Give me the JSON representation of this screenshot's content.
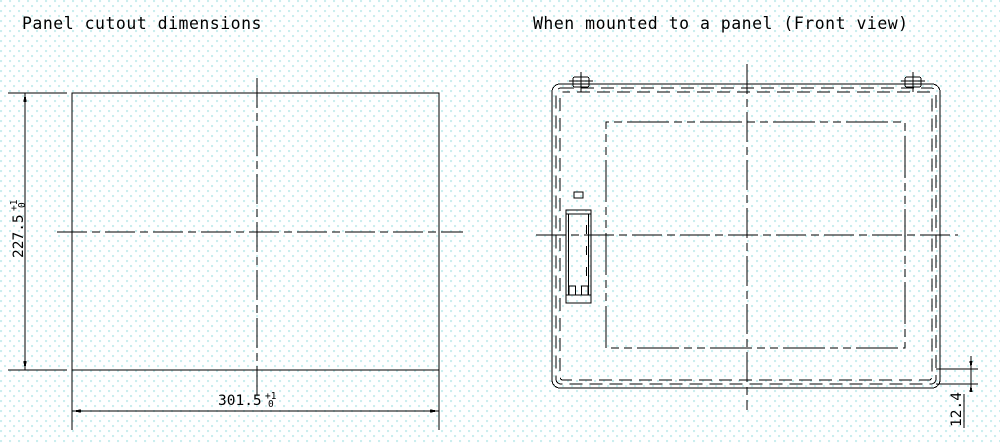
{
  "colors": {
    "line": "#000000",
    "background": "#ffffff",
    "background_dots": "#c9edee"
  },
  "left_view": {
    "title": "Panel cutout dimensions",
    "height_dimension": {
      "value": "227.5",
      "tolerance_plus": "+1",
      "tolerance_minus": "0"
    },
    "width_dimension": {
      "value": "301.5",
      "tolerance_plus": "+1",
      "tolerance_minus": "0"
    }
  },
  "right_view": {
    "title": "When mounted to a panel (Front view)",
    "depth_dimension": {
      "value": "12.4"
    }
  }
}
